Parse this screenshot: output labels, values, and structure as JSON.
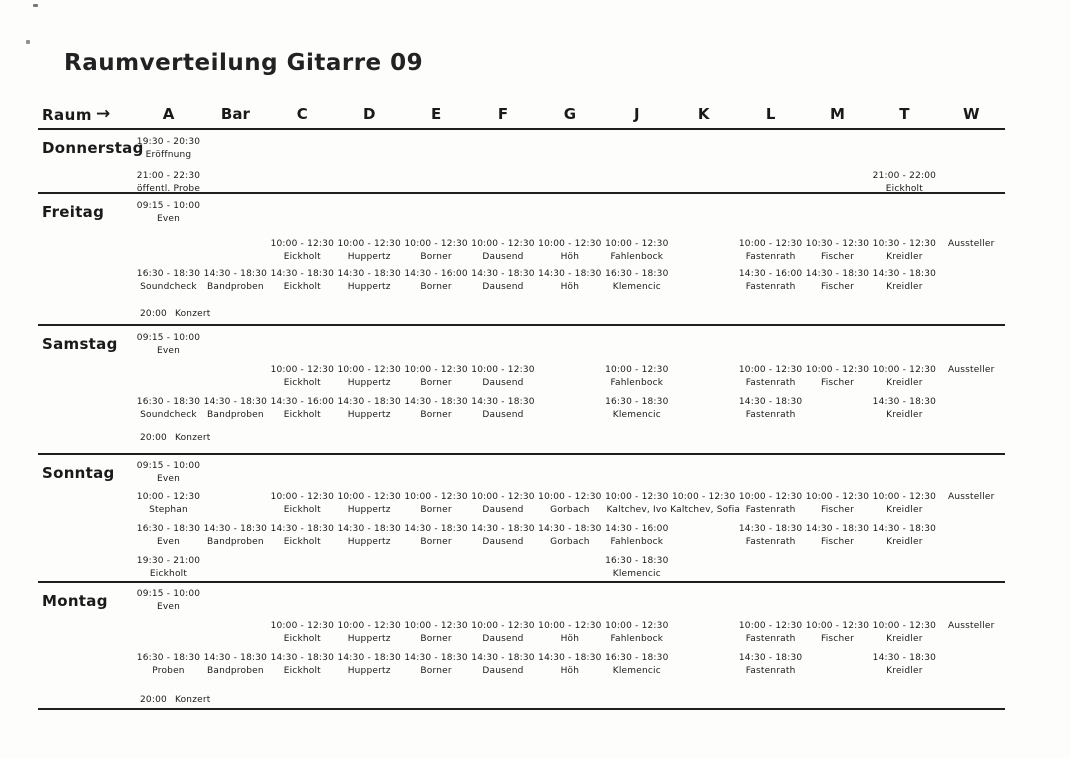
{
  "document": {
    "title": "Raumverteilung Gitarre 09",
    "header": {
      "row_label": "Raum",
      "arrow": "→",
      "columns": [
        "A",
        "Bar",
        "C",
        "D",
        "E",
        "F",
        "G",
        "J",
        "K",
        "L",
        "M",
        "T",
        "W"
      ]
    },
    "days": [
      {
        "name": "Donnerstag",
        "rows": [
          {
            "cells": [
              {
                "col": 0,
                "time": "19:30 - 20:30",
                "who": "Eröffnung"
              }
            ]
          },
          {
            "cells": [
              {
                "col": 0,
                "time": "21:00 - 22:30",
                "who": "öffentl. Probe"
              },
              {
                "col": 11,
                "time": "21:00 - 22:00",
                "who": "Eickholt"
              }
            ]
          }
        ]
      },
      {
        "name": "Freitag",
        "rows": [
          {
            "cells": [
              {
                "col": 0,
                "time": "09:15 - 10:00",
                "who": "Even"
              }
            ]
          },
          {
            "cells": [
              {
                "col": 2,
                "time": "10:00 - 12:30",
                "who": "Eickholt"
              },
              {
                "col": 3,
                "time": "10:00 - 12:30",
                "who": "Huppertz"
              },
              {
                "col": 4,
                "time": "10:00 - 12:30",
                "who": "Borner"
              },
              {
                "col": 5,
                "time": "10:00 - 12:30",
                "who": "Dausend"
              },
              {
                "col": 6,
                "time": "10:00 - 12:30",
                "who": "Höh"
              },
              {
                "col": 7,
                "time": "10:00 - 12:30",
                "who": "Fahlenbock"
              },
              {
                "col": 9,
                "time": "10:00 - 12:30",
                "who": "Fastenrath"
              },
              {
                "col": 10,
                "time": "10:30 - 12:30",
                "who": "Fischer"
              },
              {
                "col": 11,
                "time": "10:30 - 12:30",
                "who": "Kreidler"
              },
              {
                "col": 12,
                "time": "",
                "who": "Aussteller"
              }
            ]
          },
          {
            "cells": [
              {
                "col": 0,
                "time": "16:30 - 18:30",
                "who": "Soundcheck"
              },
              {
                "col": 1,
                "time": "14:30 - 18:30",
                "who": "Bandproben"
              },
              {
                "col": 2,
                "time": "14:30 - 18:30",
                "who": "Eickholt"
              },
              {
                "col": 3,
                "time": "14:30 - 18:30",
                "who": "Huppertz"
              },
              {
                "col": 4,
                "time": "14:30 - 16:00",
                "who": "Borner"
              },
              {
                "col": 5,
                "time": "14:30 - 18:30",
                "who": "Dausend"
              },
              {
                "col": 6,
                "time": "14:30 - 18:30",
                "who": "Höh"
              },
              {
                "col": 7,
                "time": "16:30 - 18:30",
                "who": "Klemencic"
              },
              {
                "col": 9,
                "time": "14:30 - 16:00",
                "who": "Fastenrath"
              },
              {
                "col": 10,
                "time": "14:30 - 18:30",
                "who": "Fischer"
              },
              {
                "col": 11,
                "time": "14:30 - 18:30",
                "who": "Kreidler"
              }
            ]
          },
          {
            "cells": [
              {
                "col": 0,
                "time": "20:00",
                "who": "Konzert",
                "inline": true
              }
            ]
          }
        ]
      },
      {
        "name": "Samstag",
        "rows": [
          {
            "cells": [
              {
                "col": 0,
                "time": "09:15 - 10:00",
                "who": "Even"
              }
            ]
          },
          {
            "cells": [
              {
                "col": 2,
                "time": "10:00 - 12:30",
                "who": "Eickholt"
              },
              {
                "col": 3,
                "time": "10:00 - 12:30",
                "who": "Huppertz"
              },
              {
                "col": 4,
                "time": "10:00 - 12:30",
                "who": "Borner"
              },
              {
                "col": 5,
                "time": "10:00 - 12:30",
                "who": "Dausend"
              },
              {
                "col": 7,
                "time": "10:00 - 12:30",
                "who": "Fahlenbock"
              },
              {
                "col": 9,
                "time": "10:00 - 12:30",
                "who": "Fastenrath"
              },
              {
                "col": 10,
                "time": "10:00 - 12:30",
                "who": "Fischer"
              },
              {
                "col": 11,
                "time": "10:00 - 12:30",
                "who": "Kreidler"
              },
              {
                "col": 12,
                "time": "",
                "who": "Aussteller"
              }
            ]
          },
          {
            "cells": [
              {
                "col": 0,
                "time": "16:30 - 18:30",
                "who": "Soundcheck"
              },
              {
                "col": 1,
                "time": "14:30 - 18:30",
                "who": "Bandproben"
              },
              {
                "col": 2,
                "time": "14:30 - 16:00",
                "who": "Eickholt"
              },
              {
                "col": 3,
                "time": "14:30 - 18:30",
                "who": "Huppertz"
              },
              {
                "col": 4,
                "time": "14:30 - 18:30",
                "who": "Borner"
              },
              {
                "col": 5,
                "time": "14:30 - 18:30",
                "who": "Dausend"
              },
              {
                "col": 7,
                "time": "16:30 - 18:30",
                "who": "Klemencic"
              },
              {
                "col": 9,
                "time": "14:30 - 18:30",
                "who": "Fastenrath"
              },
              {
                "col": 11,
                "time": "14:30 - 18:30",
                "who": "Kreidler"
              }
            ]
          },
          {
            "cells": [
              {
                "col": 0,
                "time": "20:00",
                "who": "Konzert",
                "inline": true
              }
            ]
          }
        ]
      },
      {
        "name": "Sonntag",
        "rows": [
          {
            "cells": [
              {
                "col": 0,
                "time": "09:15 - 10:00",
                "who": "Even"
              }
            ]
          },
          {
            "cells": [
              {
                "col": 0,
                "time": "10:00 - 12:30",
                "who": "Stephan"
              },
              {
                "col": 2,
                "time": "10:00 - 12:30",
                "who": "Eickholt"
              },
              {
                "col": 3,
                "time": "10:00 - 12:30",
                "who": "Huppertz"
              },
              {
                "col": 4,
                "time": "10:00 - 12:30",
                "who": "Borner"
              },
              {
                "col": 5,
                "time": "10:00 - 12:30",
                "who": "Dausend"
              },
              {
                "col": 6,
                "time": "10:00 - 12:30",
                "who": "Gorbach"
              },
              {
                "col": 7,
                "time": "10:00 - 12:30",
                "who": "Kaltchev, Ivo"
              },
              {
                "col": 8,
                "time": "10:00 - 12:30",
                "who": "Kaltchev, Sofia"
              },
              {
                "col": 9,
                "time": "10:00 - 12:30",
                "who": "Fastenrath"
              },
              {
                "col": 10,
                "time": "10:00 - 12:30",
                "who": "Fischer"
              },
              {
                "col": 11,
                "time": "10:00 - 12:30",
                "who": "Kreidler"
              },
              {
                "col": 12,
                "time": "",
                "who": "Aussteller"
              }
            ]
          },
          {
            "cells": [
              {
                "col": 0,
                "time": "16:30 - 18:30",
                "who": "Even"
              },
              {
                "col": 1,
                "time": "14:30 - 18:30",
                "who": "Bandproben"
              },
              {
                "col": 2,
                "time": "14:30 - 18:30",
                "who": "Eickholt"
              },
              {
                "col": 3,
                "time": "14:30 - 18:30",
                "who": "Huppertz"
              },
              {
                "col": 4,
                "time": "14:30 - 18:30",
                "who": "Borner"
              },
              {
                "col": 5,
                "time": "14:30 - 18:30",
                "who": "Dausend"
              },
              {
                "col": 6,
                "time": "14:30 - 18:30",
                "who": "Gorbach"
              },
              {
                "col": 7,
                "time": "14:30 - 16:00",
                "who": "Fahlenbock"
              },
              {
                "col": 9,
                "time": "14:30 - 18:30",
                "who": "Fastenrath"
              },
              {
                "col": 10,
                "time": "14:30 - 18:30",
                "who": "Fischer"
              },
              {
                "col": 11,
                "time": "14:30 - 18:30",
                "who": "Kreidler"
              }
            ]
          },
          {
            "cells": [
              {
                "col": 0,
                "time": "19:30 - 21:00",
                "who": "Eickholt"
              },
              {
                "col": 7,
                "time": "16:30 - 18:30",
                "who": "Klemencic"
              }
            ]
          }
        ]
      },
      {
        "name": "Montag",
        "rows": [
          {
            "cells": [
              {
                "col": 0,
                "time": "09:15 - 10:00",
                "who": "Even"
              }
            ]
          },
          {
            "cells": [
              {
                "col": 2,
                "time": "10:00 - 12:30",
                "who": "Eickholt"
              },
              {
                "col": 3,
                "time": "10:00 - 12:30",
                "who": "Huppertz"
              },
              {
                "col": 4,
                "time": "10:00 - 12:30",
                "who": "Borner"
              },
              {
                "col": 5,
                "time": "10:00 - 12:30",
                "who": "Dausend"
              },
              {
                "col": 6,
                "time": "10:00 - 12:30",
                "who": "Höh"
              },
              {
                "col": 7,
                "time": "10:00 - 12:30",
                "who": "Fahlenbock"
              },
              {
                "col": 9,
                "time": "10:00 - 12:30",
                "who": "Fastenrath"
              },
              {
                "col": 10,
                "time": "10:00 - 12:30",
                "who": "Fischer"
              },
              {
                "col": 11,
                "time": "10:00 - 12:30",
                "who": "Kreidler"
              },
              {
                "col": 12,
                "time": "",
                "who": "Aussteller"
              }
            ]
          },
          {
            "cells": [
              {
                "col": 0,
                "time": "16:30 - 18:30",
                "who": "Proben"
              },
              {
                "col": 1,
                "time": "14:30 - 18:30",
                "who": "Bandproben"
              },
              {
                "col": 2,
                "time": "14:30 - 18:30",
                "who": "Eickholt"
              },
              {
                "col": 3,
                "time": "14:30 - 18:30",
                "who": "Huppertz"
              },
              {
                "col": 4,
                "time": "14:30 - 18:30",
                "who": "Borner"
              },
              {
                "col": 5,
                "time": "14:30 - 18:30",
                "who": "Dausend"
              },
              {
                "col": 6,
                "time": "14:30 - 18:30",
                "who": "Höh"
              },
              {
                "col": 7,
                "time": "16:30 - 18:30",
                "who": "Klemencic"
              },
              {
                "col": 9,
                "time": "14:30 - 18:30",
                "who": "Fastenrath"
              },
              {
                "col": 11,
                "time": "14:30 - 18:30",
                "who": "Kreidler"
              }
            ]
          },
          {
            "cells": [
              {
                "col": 0,
                "time": "20:00",
                "who": "Konzert",
                "inline": true
              }
            ]
          }
        ]
      }
    ]
  }
}
